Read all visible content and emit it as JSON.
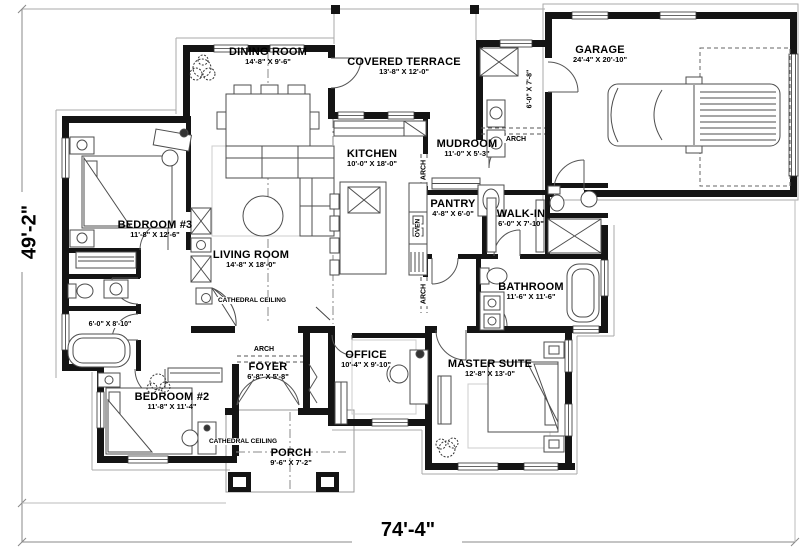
{
  "plan": {
    "overall_width": "74'-4\"",
    "overall_height": "49'-2\"",
    "rooms": [
      {
        "name": "DINING ROOM",
        "dims": "14'-8\" X 9'-6\""
      },
      {
        "name": "COVERED TERRACE",
        "dims": "13'-8\" X 12'-0\""
      },
      {
        "name": "GARAGE",
        "dims": "24'-4\" X 20'-10\""
      },
      {
        "name": "KITCHEN",
        "dims": "10'-0\" X 18'-0\""
      },
      {
        "name": "MUDROOM",
        "dims": "11'-0\" X 5'-3\""
      },
      {
        "name": "PANTRY",
        "dims": "4'-8\" X 6'-0\""
      },
      {
        "name": "WALK-IN",
        "dims": "6'-0\" X 7'-10\""
      },
      {
        "name": "BEDROOM #3",
        "dims": "11'-8\" X 12'-6\""
      },
      {
        "name": "LIVING ROOM",
        "dims": "14'-8\" X 18'-0\""
      },
      {
        "name": "BATHROOM",
        "dims": "11'-6\" X 11'-6\""
      },
      {
        "name": "OFFICE",
        "dims": "10'-4\" X 9'-10\""
      },
      {
        "name": "MASTER SUITE",
        "dims": "12'-8\" X 13'-0\""
      },
      {
        "name": "BEDROOM #2",
        "dims": "11'-8\" X 11'-4\""
      },
      {
        "name": "FOYER",
        "dims": "6'-8\" X 5'-8\""
      },
      {
        "name": "PORCH",
        "dims": "9'-6\" X 7'-2\""
      }
    ],
    "annotations": {
      "arch": "ARCH",
      "cathedral_ceiling": "CATHEDRAL CEILING",
      "oven": "OVEN",
      "bath_dims": "6'-0\" X 8'-10\"",
      "hall_dims": "6'-0\" X 7'-8\""
    }
  }
}
